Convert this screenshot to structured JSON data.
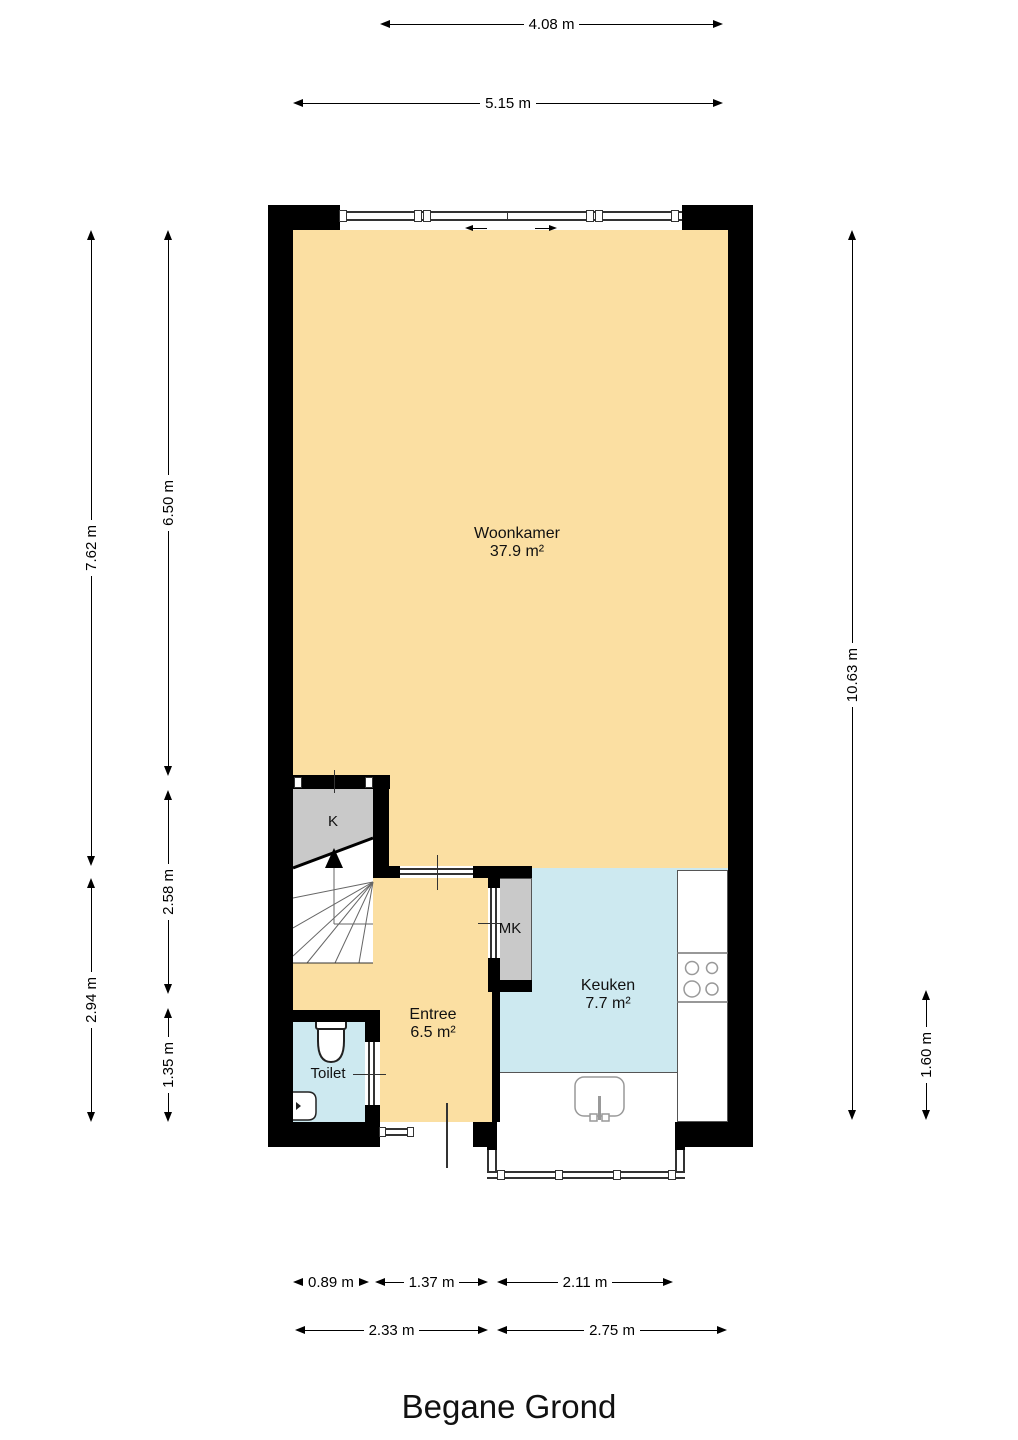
{
  "title": "Begane Grond",
  "rooms": {
    "woonkamer": {
      "name": "Woonkamer",
      "area": "37.9 m²"
    },
    "keuken": {
      "name": "Keuken",
      "area": "7.7 m²"
    },
    "entree": {
      "name": "Entree",
      "area": "6.5 m²"
    },
    "toilet": {
      "name": "Toilet"
    },
    "closet_k": {
      "name": "K"
    },
    "meterkast": {
      "name": "MK"
    }
  },
  "dimensions": {
    "top": [
      "4.08 m",
      "5.15 m"
    ],
    "left_outer": [
      "7.62 m",
      "2.94 m"
    ],
    "left_inner": [
      "6.50 m",
      "2.58 m",
      "1.35 m"
    ],
    "right": [
      "10.63 m",
      "1.60 m"
    ],
    "bottom_upper": [
      "0.89 m",
      "1.37 m",
      "2.11 m"
    ],
    "bottom_lower": [
      "2.33 m",
      "2.75 m"
    ]
  },
  "colors": {
    "wall": "#000000",
    "floor_warm": "#FBDFA2",
    "floor_cool": "#CDE9F0",
    "closet": "#C9C9C9",
    "fixture_outline": "#999999"
  }
}
